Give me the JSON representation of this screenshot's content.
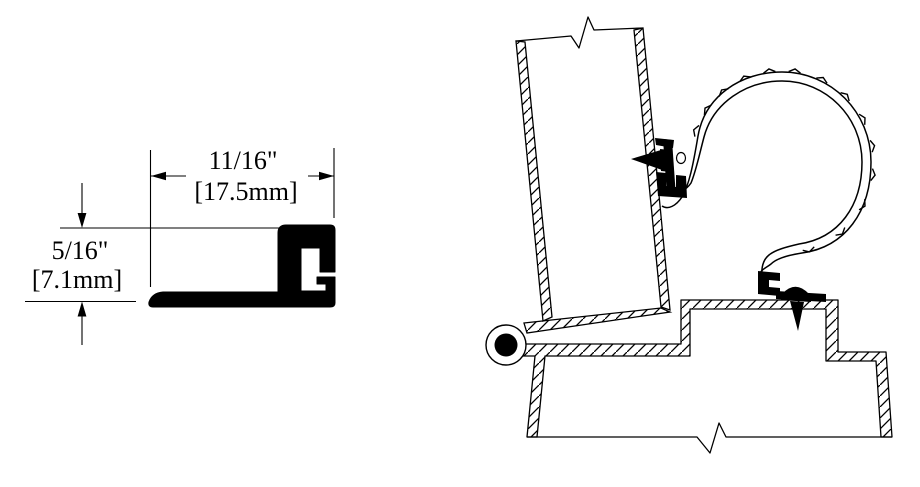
{
  "canvas": {
    "background": "#ffffff",
    "ink": "#000000"
  },
  "profile_drawing": {
    "width_dimension": {
      "imperial": "11/16\"",
      "metric": "[17.5mm]"
    },
    "height_dimension": {
      "imperial": "5/16\"",
      "metric": "[7.1mm]"
    }
  }
}
